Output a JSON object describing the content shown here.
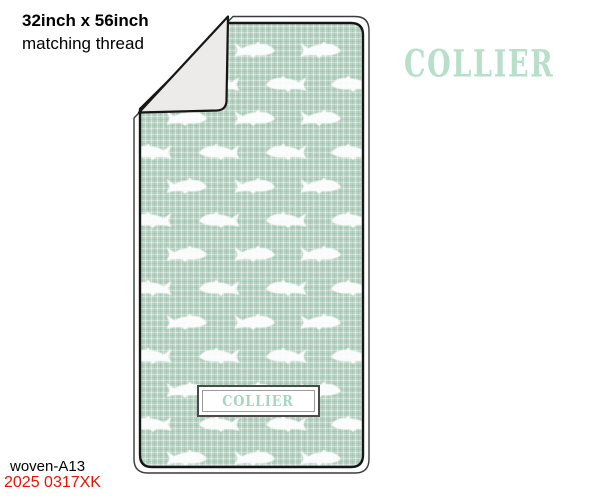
{
  "annotations": {
    "size": "32inch x 56inch",
    "thread": "matching thread",
    "sku": "woven-A13",
    "code": "2025 0317XK"
  },
  "brand": {
    "wordmark": "COLLIER"
  },
  "blanket": {
    "name_label": {
      "text": "COLLIER"
    },
    "motifs": {
      "icon": "fish-icon",
      "description": "white fish silhouettes on woven sage linen, sherpa backing shown by folded corner"
    },
    "pattern": {
      "fish_width": 42,
      "rows": [
        {
          "y": 50,
          "dir": -1,
          "xs": [
            118,
            186,
            254,
            320
          ]
        },
        {
          "y": 84,
          "dir": 1,
          "xs": [
            152,
            220,
            287,
            352
          ]
        },
        {
          "y": 118,
          "dir": -1,
          "xs": [
            118,
            186,
            254,
            320
          ]
        },
        {
          "y": 152,
          "dir": 1,
          "xs": [
            152,
            220,
            287,
            352
          ]
        },
        {
          "y": 186,
          "dir": -1,
          "xs": [
            118,
            186,
            254,
            320
          ]
        },
        {
          "y": 220,
          "dir": 1,
          "xs": [
            152,
            220,
            287,
            352
          ]
        },
        {
          "y": 254,
          "dir": -1,
          "xs": [
            118,
            186,
            254,
            320
          ]
        },
        {
          "y": 288,
          "dir": 1,
          "xs": [
            152,
            220,
            287,
            352
          ]
        },
        {
          "y": 322,
          "dir": -1,
          "xs": [
            118,
            186,
            254,
            320
          ]
        },
        {
          "y": 356,
          "dir": 1,
          "xs": [
            152,
            220,
            287,
            352
          ]
        },
        {
          "y": 390,
          "dir": -1,
          "xs": [
            118,
            186,
            254,
            320
          ]
        },
        {
          "y": 424,
          "dir": 1,
          "xs": [
            152,
            220,
            287,
            352
          ]
        },
        {
          "y": 458,
          "dir": -1,
          "xs": [
            118,
            186,
            254,
            320
          ]
        }
      ]
    }
  },
  "colors": {
    "fabric-base": "#b6d2c2",
    "fish": "#ffffff",
    "backing": "#efeeec",
    "mint": "#b7dfca",
    "mint-dark": "#a5d6bf",
    "red": "#ee1100",
    "outline": "#1a1a1a"
  }
}
